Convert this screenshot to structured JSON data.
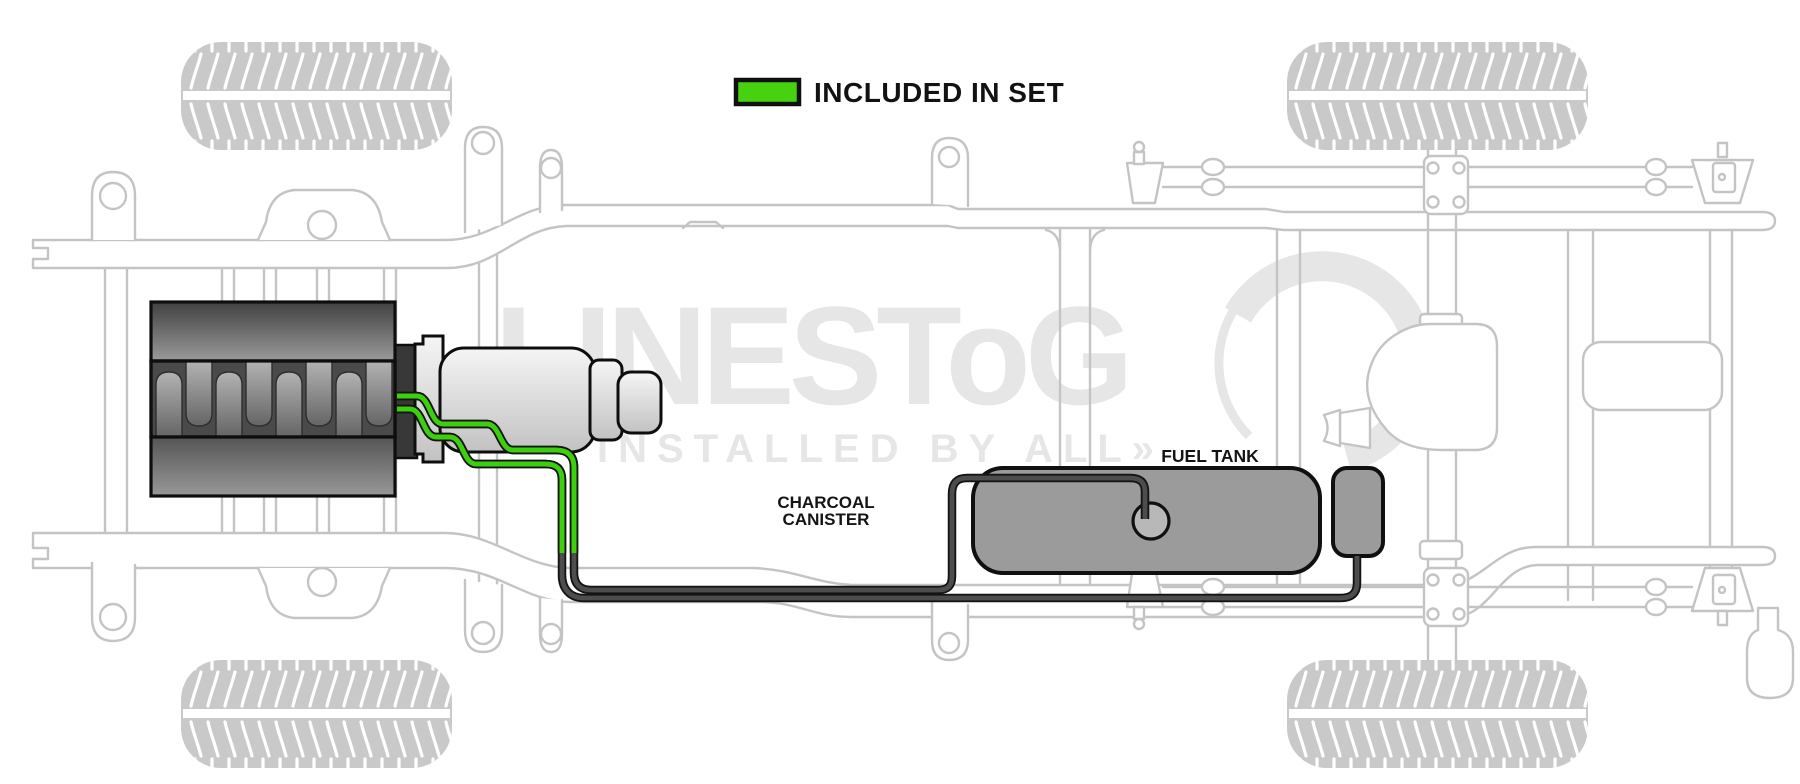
{
  "legend": {
    "label": "INCLUDED IN SET",
    "swatch_color": "#46d20f"
  },
  "labels": {
    "charcoal_line1": "CHARCOAL",
    "charcoal_line2": "CANISTER",
    "fuel_tank": "FUEL TANK"
  },
  "watermark": {
    "brand": "LINESToG",
    "tagline": "INSTALLED BY ALL»",
    "text_color": "#e6e6e6",
    "ring_color": "#e6e6e6"
  },
  "colors": {
    "line_green": "#3bcf0e",
    "line_dark": "#4d4d4d",
    "chassis_gray": "#c4c4c4",
    "tire_gray": "#c9c9c9",
    "tank_gray": "#9b9b9b",
    "sender_gray": "#b8b8b8"
  }
}
